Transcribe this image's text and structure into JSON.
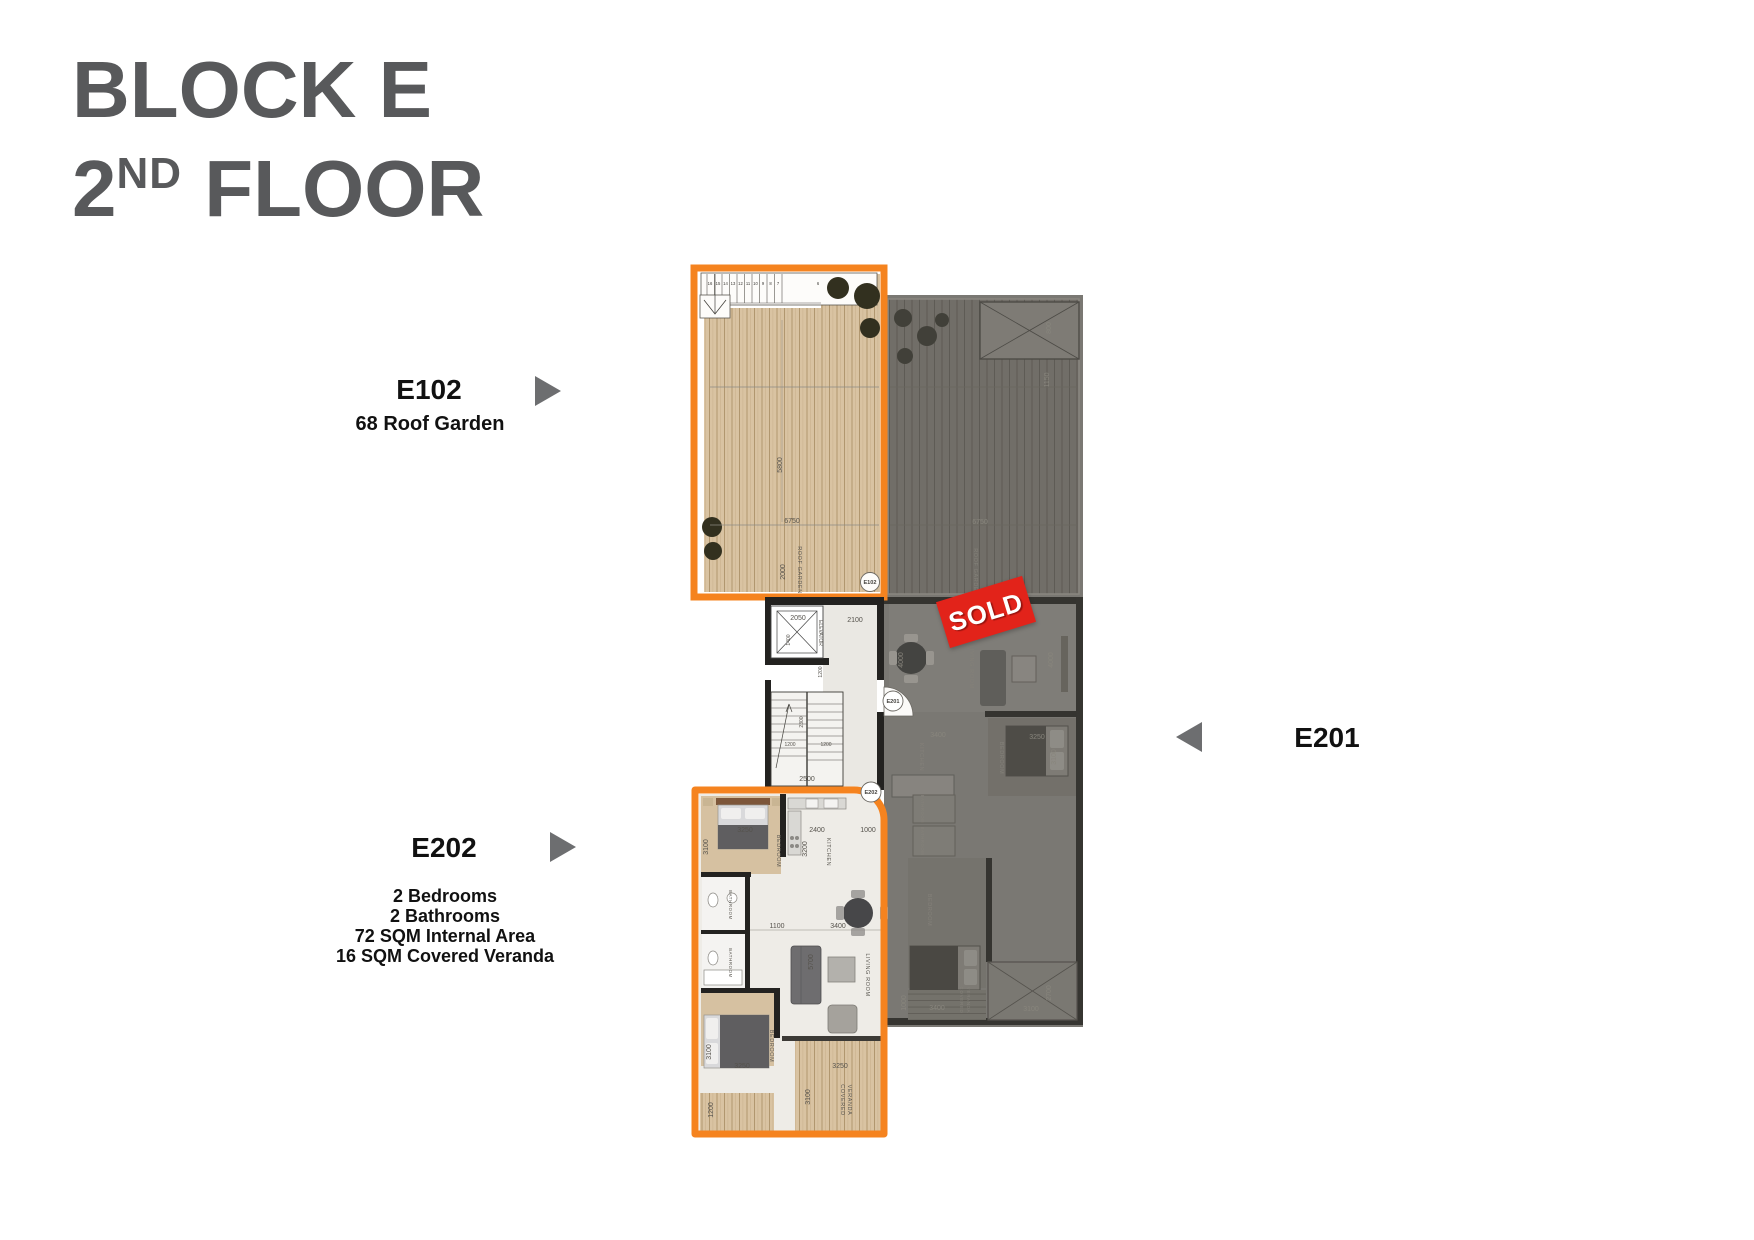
{
  "title": {
    "line1": "BLOCK E",
    "floor_number": "2",
    "floor_ordinal": "ND",
    "floor_word": " FLOOR"
  },
  "units": {
    "e102": {
      "name": "E102",
      "subtitle": "68 Roof Garden"
    },
    "e201": {
      "name": "E201"
    },
    "e202": {
      "name": "E202",
      "features": [
        "2 Bedrooms",
        "2 Bathrooms",
        "72 SQM Internal Area",
        "16 SQM Covered Veranda"
      ]
    }
  },
  "badges": {
    "sold": "SOLD"
  },
  "colors": {
    "accent_orange": "#f5831f",
    "title_gray": "#58595b",
    "arrow_gray": "#6d6e70",
    "sold_red": "#e2231a"
  },
  "plan": {
    "stair_numbers": [
      "16",
      "15",
      "14",
      "13",
      "12",
      "11",
      "10",
      "9",
      "8",
      "7",
      "6"
    ],
    "labels": {
      "roof_garden": "ROOF GARDEN",
      "elevator": "ELEVATOR",
      "kitchen": "KITCHEN",
      "bedroom": "BEDROOM",
      "bathroom": "BATHROOM",
      "living_room": "LIVING ROOM",
      "covered": "COVERED",
      "veranda": "VERANDA",
      "e102": "E102",
      "e201": "E201",
      "e202": "E202"
    },
    "dims": {
      "roof_w": "6750",
      "roof_d": "5800",
      "roof_s": "2000",
      "elev_w": "2050",
      "elev_d": "1400",
      "lobby_w": "2100",
      "stair_a": "1200",
      "stair_b": "2300",
      "stair_c": "2500",
      "bed_w": "3250",
      "bed_d": "3100",
      "kitchen_w": "2400",
      "hall_w": "1000",
      "kitchen_d": "3200",
      "pass_w": "1100",
      "living_w": "3400",
      "sofa_l": "5700",
      "deck_w": "1200",
      "gray_living_d": "4000",
      "gray_sky": "800",
      "gray_sky2": "1150",
      "gray_ver_w": "3100",
      "gray_ver_d": "2700",
      "gray_ver2_w": "3400",
      "gray_1000": "1000"
    }
  }
}
